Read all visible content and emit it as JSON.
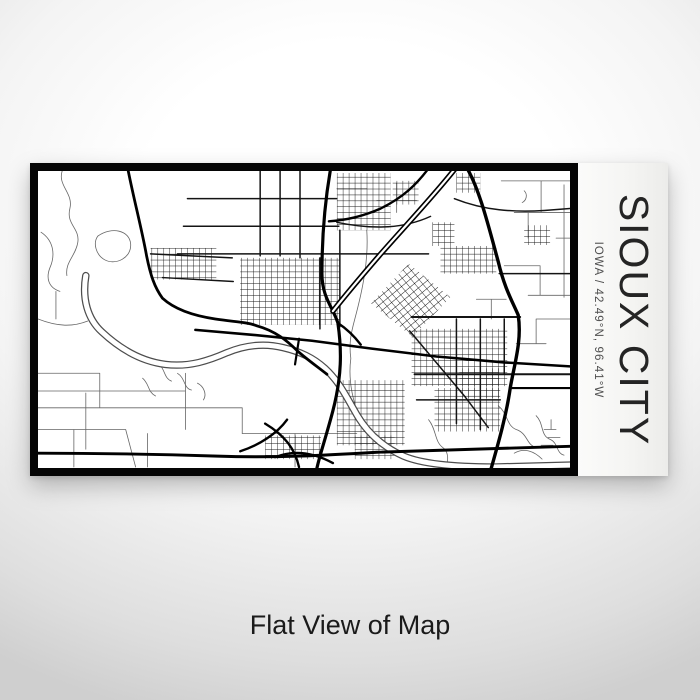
{
  "product": {
    "title": "SIOUX CITY",
    "subtitle": "IOWA / 42.49°N, 96.41°W",
    "map_style": {
      "ink": "#0a0a0a",
      "paper": "#ffffff",
      "frame": "#000000",
      "river_outline": "#4d4d4d"
    }
  },
  "caption": "Flat View of Map"
}
